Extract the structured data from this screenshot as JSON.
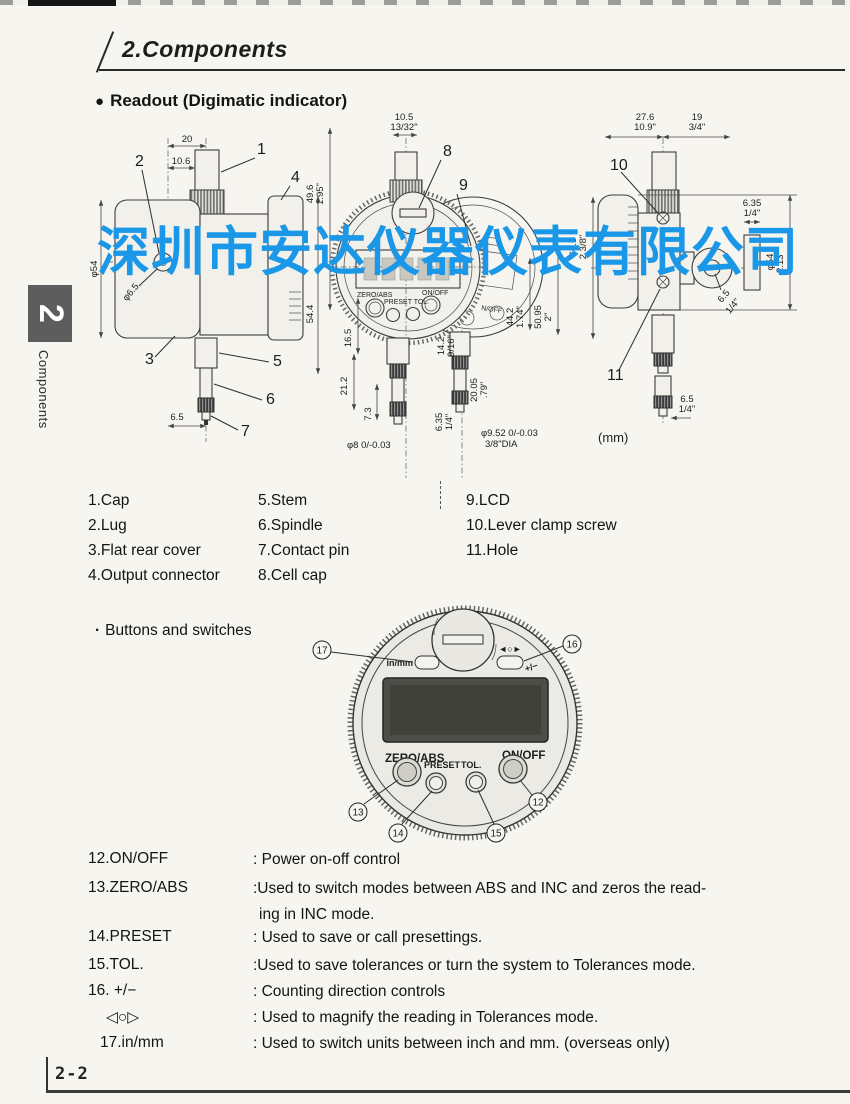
{
  "header": {
    "title": "2.Components"
  },
  "readout": {
    "bullet": "●",
    "title": "Readout (Digimatic indicator)"
  },
  "watermark": {
    "text": "深圳市安达仪器仪表有限公司",
    "color": "#1b97e8"
  },
  "sidebar": {
    "number": "2",
    "label": "Components"
  },
  "drawing": {
    "units_note": "(mm)",
    "left": {
      "c1": "1",
      "c2": "2",
      "c3": "3",
      "c4": "4",
      "c5": "5",
      "c6": "6",
      "c7": "7",
      "d20": "20",
      "d106": "10.6",
      "dphi54": "φ54",
      "d544": "54.4",
      "dphi65": "φ6.5",
      "d65": "6.5"
    },
    "front": {
      "c8": "8",
      "c9": "9",
      "d105": "10.5",
      "d1332": "13/32\"",
      "d496": "49.6",
      "d195": "1.95\"",
      "d165": "16.5",
      "d212": "21.2",
      "d73": "7.3",
      "dphi8": "φ8 0/-0.03",
      "d142": "14.2",
      "d916": "9/16\"",
      "d2005": "20.05",
      "d79": ".79\"",
      "d635": "6.35",
      "d14": "1/4\"",
      "dphi952": "φ9.52 0/-0.03",
      "d38": "3/8\"DIA",
      "d442": "44.2",
      "d174": "1.74\"",
      "d5095": "50.95",
      "d2in": "2\"",
      "d605": "60.5",
      "d238": "2 3/8\"",
      "zeroabs": "ZERO/ABS",
      "onoff": "ON/OFF",
      "presettol": "PRESET TOL.",
      "onoff2": "N/OFF"
    },
    "right": {
      "c10": "10",
      "c11": "11",
      "d276": "27.6",
      "d109": "10.9\"",
      "d19": "19",
      "d34": "3/4\"",
      "d635": "6.35",
      "d14a": "1/4\"",
      "dphi54": "φ54",
      "d213": "2.13\"",
      "d65a": "6.5",
      "d14b": "1/4\"",
      "d65b": "6.5",
      "d14c": "1/4\""
    }
  },
  "parts": {
    "col1": [
      "1.Cap",
      "2.Lug",
      "3.Flat rear cover",
      "4.Output connector"
    ],
    "col2": [
      "5.Stem",
      "6.Spindle",
      "7.Contact pin",
      "8.Cell cap"
    ],
    "col3": [
      "9.LCD",
      "10.Lever clamp screw",
      "11.Hole"
    ]
  },
  "buttons_section": {
    "bullet": "·",
    "title": "Buttons and switches"
  },
  "face": {
    "in_mm": "in/mm",
    "dir": "◄○►",
    "plus_minus": "+/−",
    "zero_abs": "ZERO/ABS",
    "on_off": "ON/OFF",
    "preset": "PRESET",
    "tol": "TOL.",
    "n12": "12",
    "n13": "13",
    "n14": "14",
    "n15": "15",
    "n16": "16",
    "n17": "17"
  },
  "controls": [
    {
      "term": "12.ON/OFF",
      "desc": ": Power on-off control"
    },
    {
      "term": "13.ZERO/ABS",
      "desc": ":Used to switch modes between ABS and INC and zeros the read-",
      "desc2": "ing in INC mode."
    },
    {
      "term": "14.PRESET",
      "desc": ": Used to save or call presettings."
    },
    {
      "term": "15.TOL.",
      "desc": ":Used to save tolerances or turn the system to Tolerances mode."
    },
    {
      "term": "16. +/−",
      "desc": ": Counting direction controls"
    },
    {
      "term": "◁○▷",
      "desc": ": Used to magnify the reading in Tolerances mode."
    },
    {
      "term": "17.in/mm",
      "desc": ": Used to switch units between inch and mm.  (overseas only)"
    }
  ],
  "footer": {
    "page": "2-2"
  }
}
